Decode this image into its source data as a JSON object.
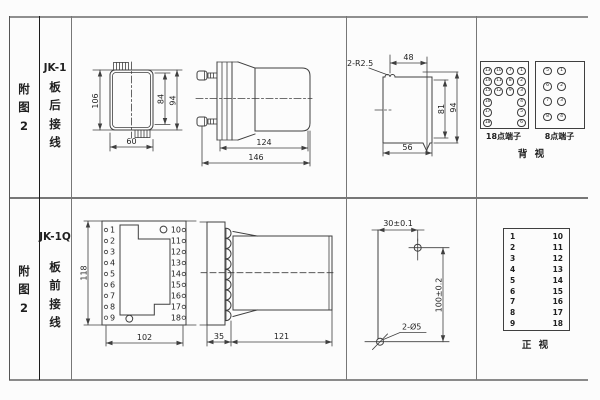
{
  "palette": {
    "background": "#fcfcfc",
    "line": "#3f3f3f",
    "grid_light": "#8a8a8a",
    "grid_dark": "#1c1c1c",
    "text": "#1f1f1f"
  },
  "rows": [
    {
      "fig_label": [
        "附",
        "图",
        "2"
      ],
      "model": "JK-1",
      "wiring": [
        "板",
        "后",
        "接",
        "线"
      ]
    },
    {
      "fig_label": [
        "附",
        "图",
        "2"
      ],
      "model": "JK-1Q",
      "wiring": [
        "板",
        "前",
        "接",
        "线"
      ]
    }
  ],
  "jk1": {
    "front": {
      "dim_height": "106",
      "dim_inner": "84",
      "dim_outer": "94",
      "dim_width": "60"
    },
    "side": {
      "dim_body": "124",
      "dim_total": "146"
    },
    "cutout": {
      "radius_note": "2-R2.5",
      "dim_top": "48",
      "dim_inner_h": "81",
      "dim_outer_h": "94",
      "dim_bottom": "56"
    },
    "terminals": {
      "t18": {
        "label": "18点端子",
        "cells": [
          "13",
          "10",
          "7",
          "1",
          "14",
          "11",
          "8",
          "2",
          "15",
          "12",
          "9",
          "3",
          "16",
          "4",
          "17",
          "5",
          "18",
          "6"
        ]
      },
      "t8": {
        "label": "8点端子",
        "cells": [
          "5",
          "1",
          "6",
          "2",
          "7",
          "3",
          "8",
          "4"
        ]
      },
      "view": "背  视"
    }
  },
  "jk1q": {
    "front": {
      "dim_height": "118",
      "dim_width": "102",
      "left": [
        "1",
        "2",
        "3",
        "4",
        "5",
        "6",
        "7",
        "8",
        "9"
      ],
      "right": [
        "10",
        "11",
        "12",
        "13",
        "14",
        "15",
        "16",
        "17",
        "18"
      ]
    },
    "side": {
      "dim_flange": "35",
      "dim_body": "121"
    },
    "drill": {
      "dim_h": "30±0.1",
      "dim_v": "100±0.2",
      "hole_note": "2-Ø5"
    },
    "table": {
      "left": [
        "1",
        "2",
        "3",
        "4",
        "5",
        "6",
        "7",
        "8",
        "9"
      ],
      "right": [
        "10",
        "11",
        "12",
        "13",
        "14",
        "15",
        "16",
        "17",
        "18"
      ],
      "view": "正  视"
    }
  }
}
